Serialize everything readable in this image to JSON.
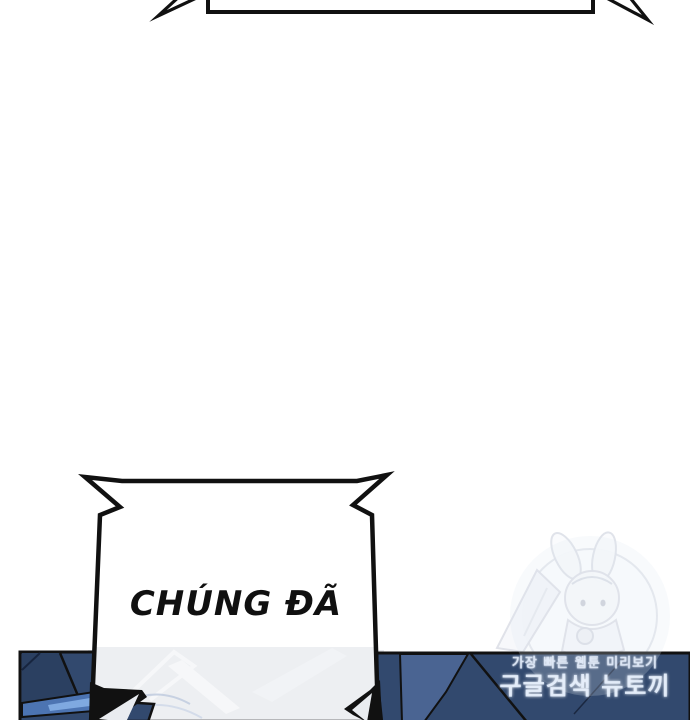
{
  "page": {
    "type": "webtoon-comic-panel",
    "background": "#ffffff"
  },
  "top_bubble": {
    "style": "rectangular shout bubble, cut off at top edge, tails pointing down-left and down-right"
  },
  "bottom_bubble": {
    "text": "CHÚNG ĐÃ",
    "style": "jagged rectangular shout bubble with corner spikes"
  },
  "watermark": {
    "line_small": "가장 빠른 웹툰 미리보기",
    "line_large": "구글검색 뉴토끼",
    "character": "faint bunny-ear chibi girl in circle emblem"
  },
  "colors": {
    "outline_black": "#111111",
    "panel_navy": "#32496e",
    "panel_navy_dark": "#2b4061",
    "panel_blue_mid": "#4a6492",
    "panel_blue_band": "#4c74b2",
    "panel_blue_bright": "#7fa9e0",
    "panel_glow": "#e9ebef",
    "glow_streak": "#f6f7f9",
    "glow_arc": "#c7d1e2",
    "wedge_light": "#e9ecf0",
    "watermark_line": "#e3e5ea",
    "haze": "#dfe7f3"
  }
}
